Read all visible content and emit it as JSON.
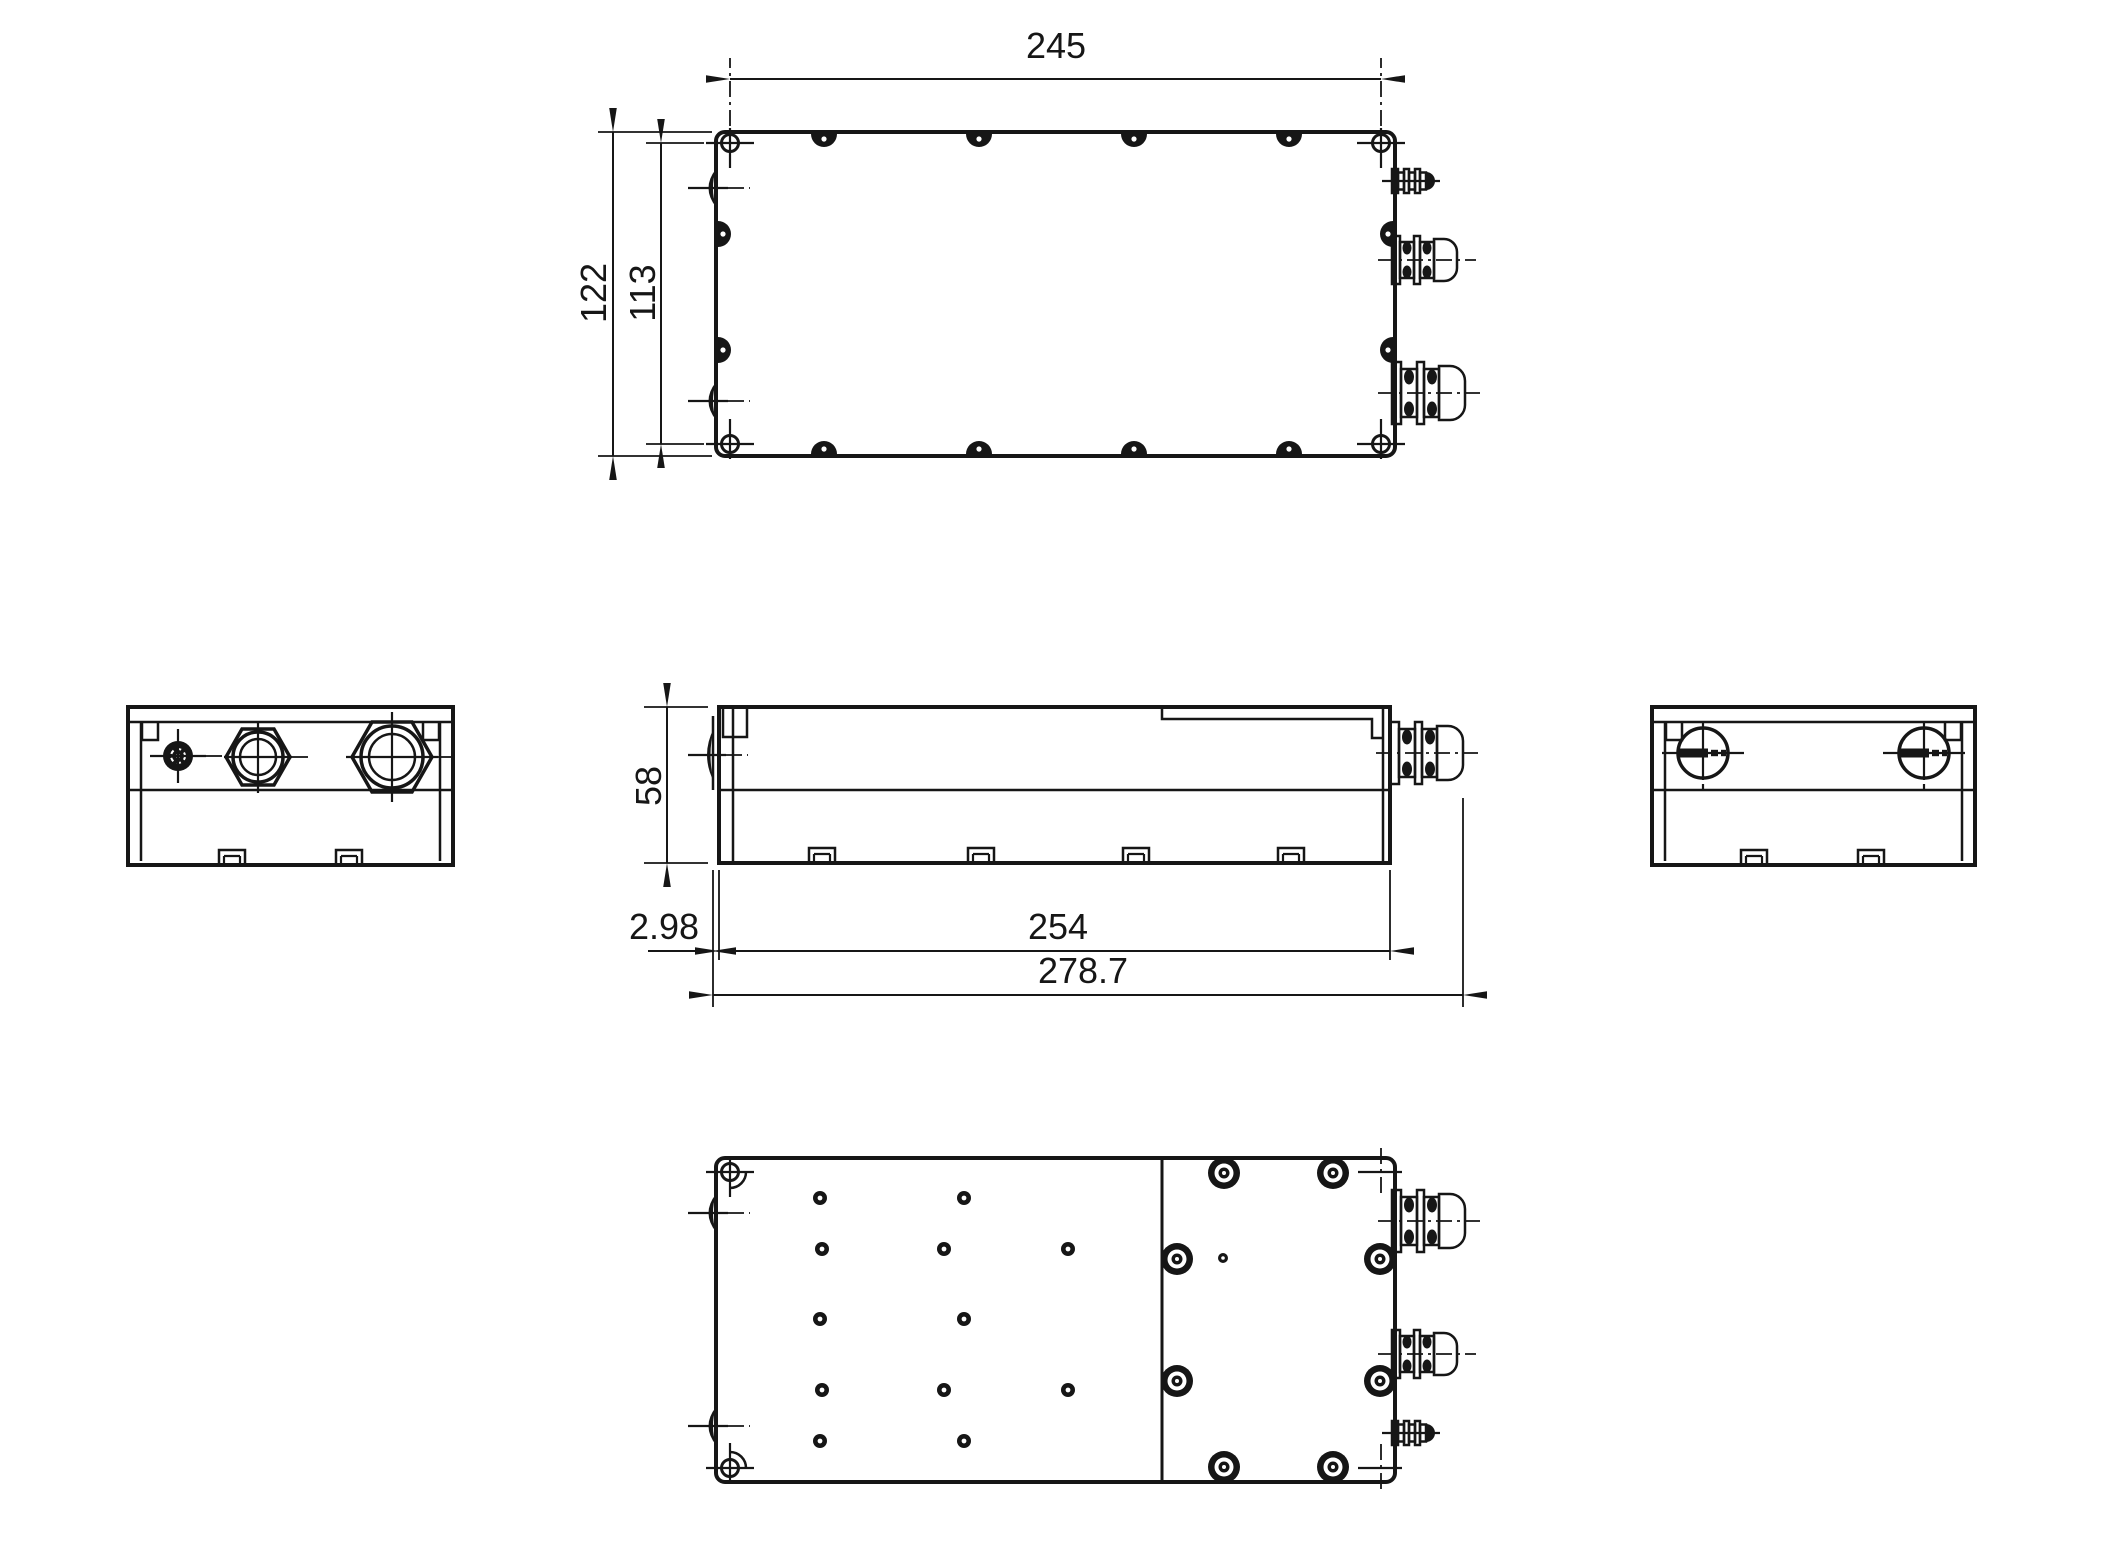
{
  "drawing": {
    "background": "#ffffff",
    "ink": "#161616",
    "dimensions": {
      "top_view": {
        "length": "245",
        "depth_overall": "122",
        "hole_spacing": "113"
      },
      "front_view": {
        "height": "58",
        "lip_offset": "2.98",
        "body_length": "254",
        "overall_length": "278.7"
      }
    }
  }
}
